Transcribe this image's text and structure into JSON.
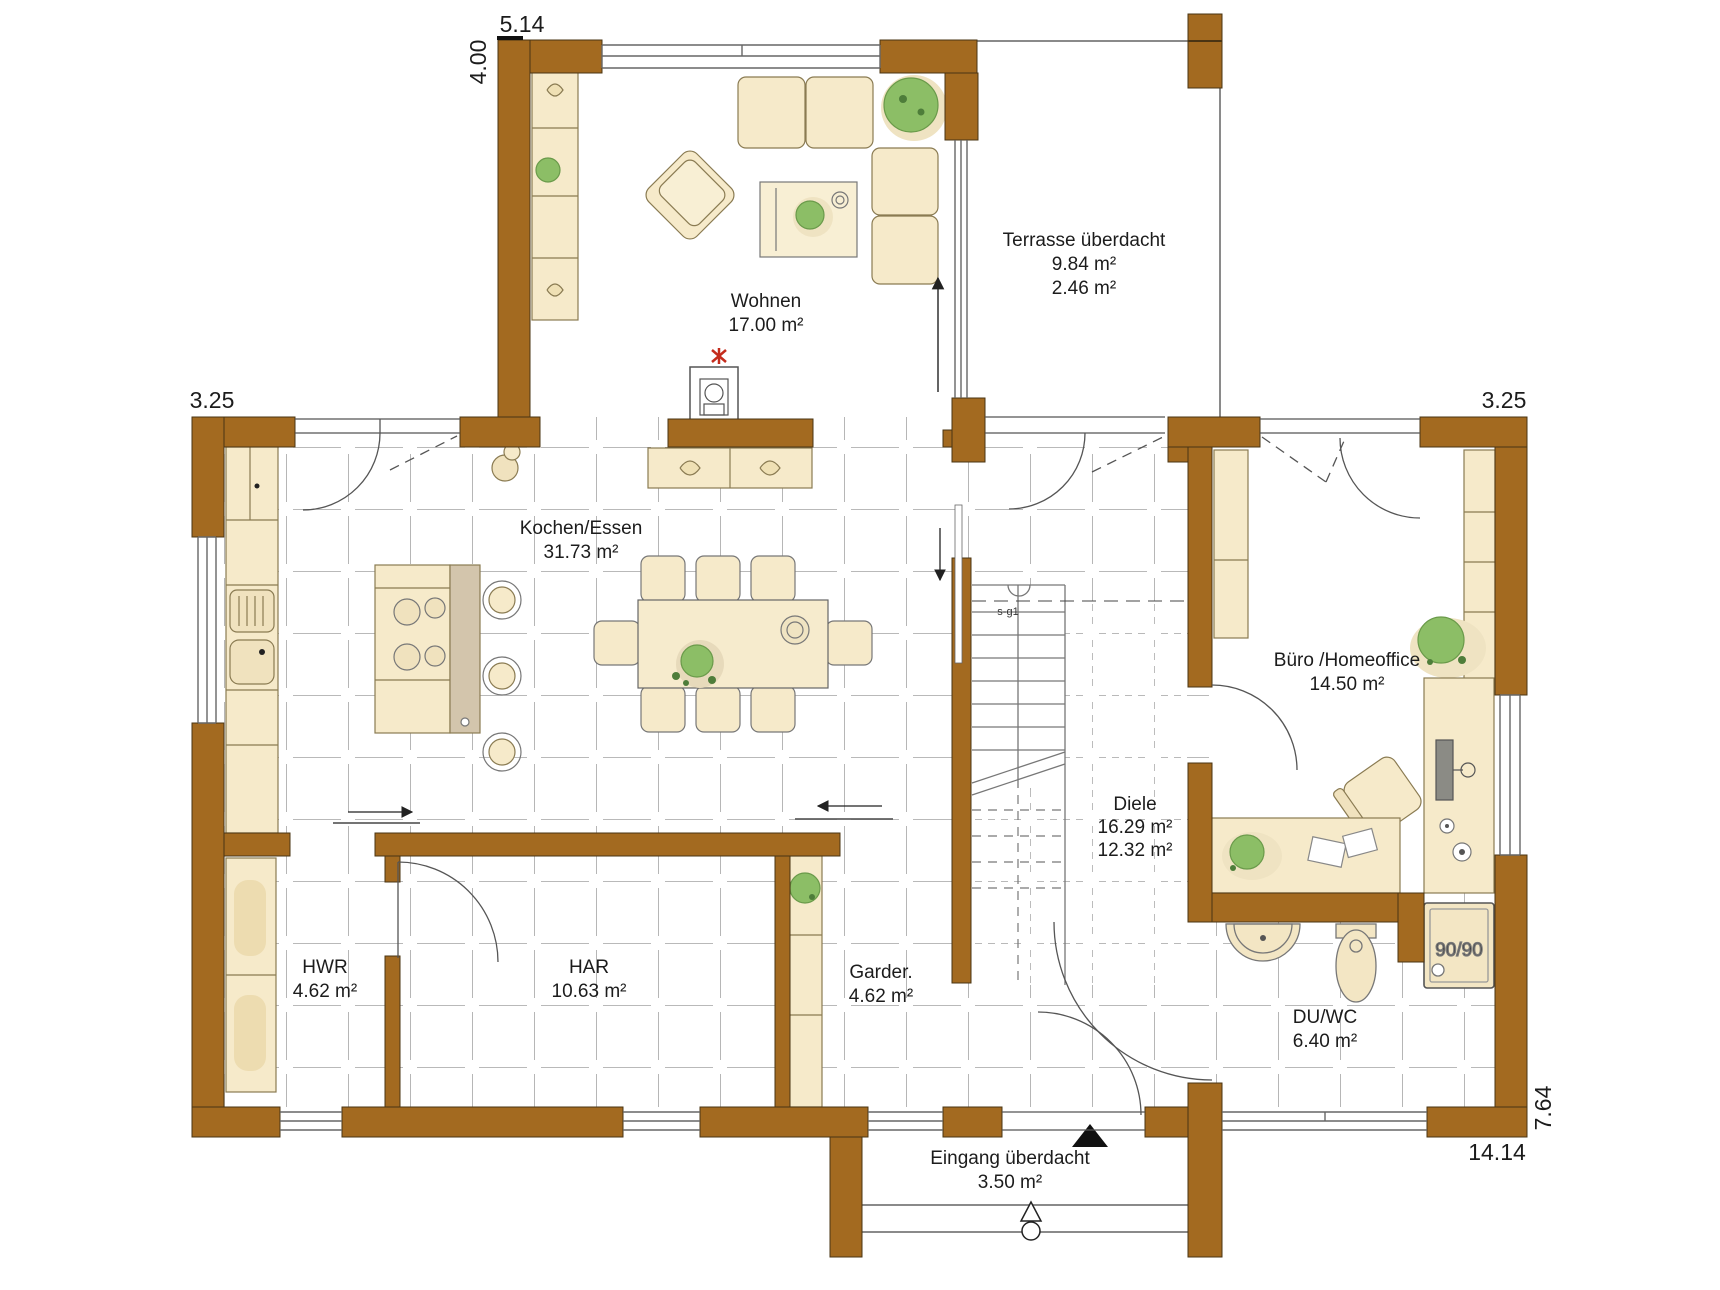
{
  "rooms": {
    "wohnen": {
      "name": "Wohnen",
      "area": "17.00 m²"
    },
    "terrasse": {
      "name": "Terrasse überdacht",
      "area": "9.84 m²",
      "area2": "2.46 m²"
    },
    "kochen": {
      "name": "Kochen/Essen",
      "area": "31.73 m²"
    },
    "buero": {
      "name": "Büro /Homeoffice",
      "area": "14.50 m²"
    },
    "diele": {
      "name": "Diele",
      "area": "16.29 m²",
      "area2": "12.32 m²"
    },
    "hwr": {
      "name": "HWR",
      "area": "4.62 m²"
    },
    "har": {
      "name": "HAR",
      "area": "10.63 m²"
    },
    "garderobe": {
      "name": "Garder.",
      "area": "4.62 m²"
    },
    "duwc": {
      "name": "DU/WC",
      "area": "6.40 m²"
    },
    "eingang": {
      "name": "Eingang überdacht",
      "area": "3.50 m²"
    }
  },
  "dimensions": {
    "top": "5.14",
    "top_left_side": "4.00",
    "left": "3.25",
    "right": "3.25",
    "bottom": "14.14",
    "bottom_right_side": "7.64"
  },
  "annotations": {
    "shower": "90/90",
    "stair_section": "s-g1"
  },
  "colors": {
    "wall": "#A36A20",
    "wall_outline": "#4A3413",
    "furniture": "#F6EACA",
    "furniture_dark": "#EDDCB0",
    "counter_gray": "#D3C5AC",
    "plant": "#8CBE66",
    "plant_dark": "#4E7D3A",
    "tile_line": "#8F8F8F",
    "accent_red": "#C42B1C"
  }
}
